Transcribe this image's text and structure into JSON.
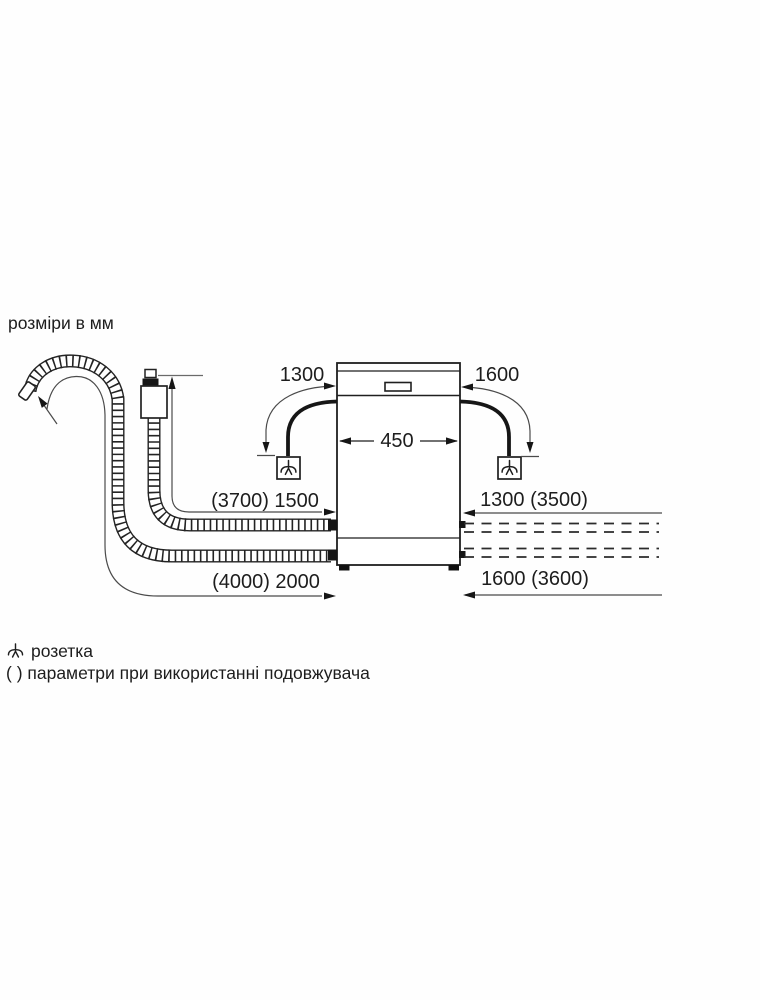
{
  "header": {
    "title": "розміри в мм"
  },
  "diagram": {
    "appliance": "dishwasher-front-view",
    "appliance_width_label": "450",
    "labels": {
      "cable_left_length": "1300",
      "cable_right_length": "1600",
      "width": "450",
      "supply_hose_length": "(3700) 1500",
      "right_upper_length": "1300 (3500)",
      "drain_hose_length": "(4000) 2000",
      "right_lower_length": "1600 (3600)"
    },
    "colors": {
      "line": "#1f1f1f",
      "thin_line": "#4a4a4a",
      "background": "#fefefe"
    },
    "icons": [
      "socket-icon",
      "drain-hose",
      "supply-hose",
      "aquastop-valve"
    ]
  },
  "legend": {
    "socket_label": "розетка",
    "parentheses_note": "( ) параметри при використанні подовжувача"
  }
}
